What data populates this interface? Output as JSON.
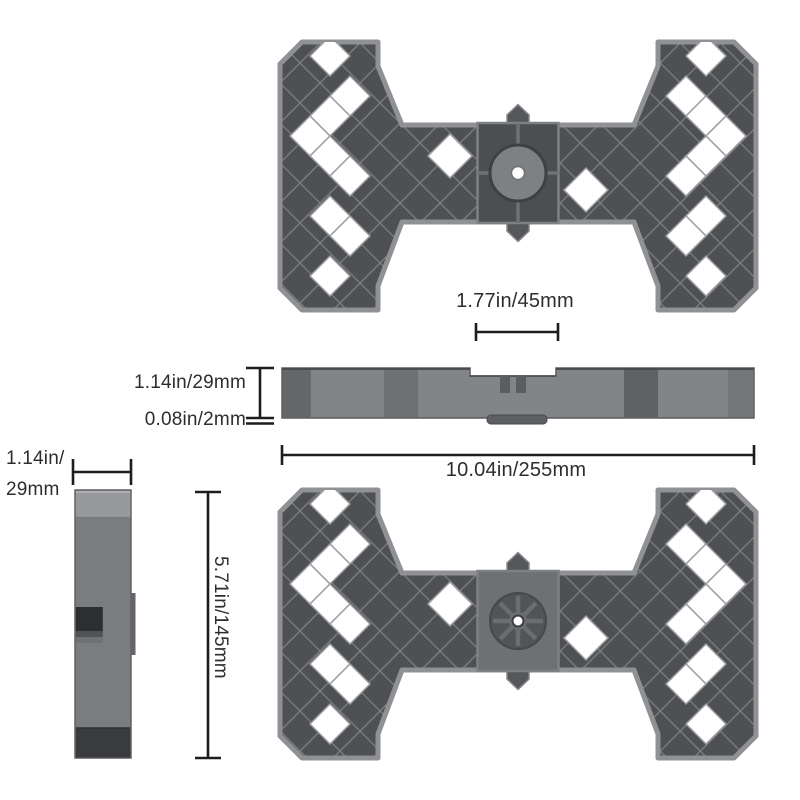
{
  "dimensions": {
    "hub_width": {
      "label": "1.77in/45mm"
    },
    "side_height": {
      "label": "1.14in/29mm"
    },
    "base_thickness": {
      "label": "0.08in/2mm"
    },
    "total_length": {
      "label": "10.04in/255mm"
    },
    "end_width": {
      "line1": "1.14in/",
      "line2": "29mm"
    },
    "plate_depth": {
      "label": "5.71in/145mm"
    }
  },
  "colors": {
    "background": "#ffffff",
    "plastic_body": "#838487",
    "plastic_cell_dark": "#4e5053",
    "plastic_rib": "#7d8083",
    "plastic_rim": "#8f9194",
    "plastic_light_top": "#98999b",
    "plastic_shadow_dark": "#3a3b3d",
    "hole_white": "#ffffff",
    "dimension_line": "#1d1d1f",
    "dimension_text": "#2c2d2f"
  }
}
